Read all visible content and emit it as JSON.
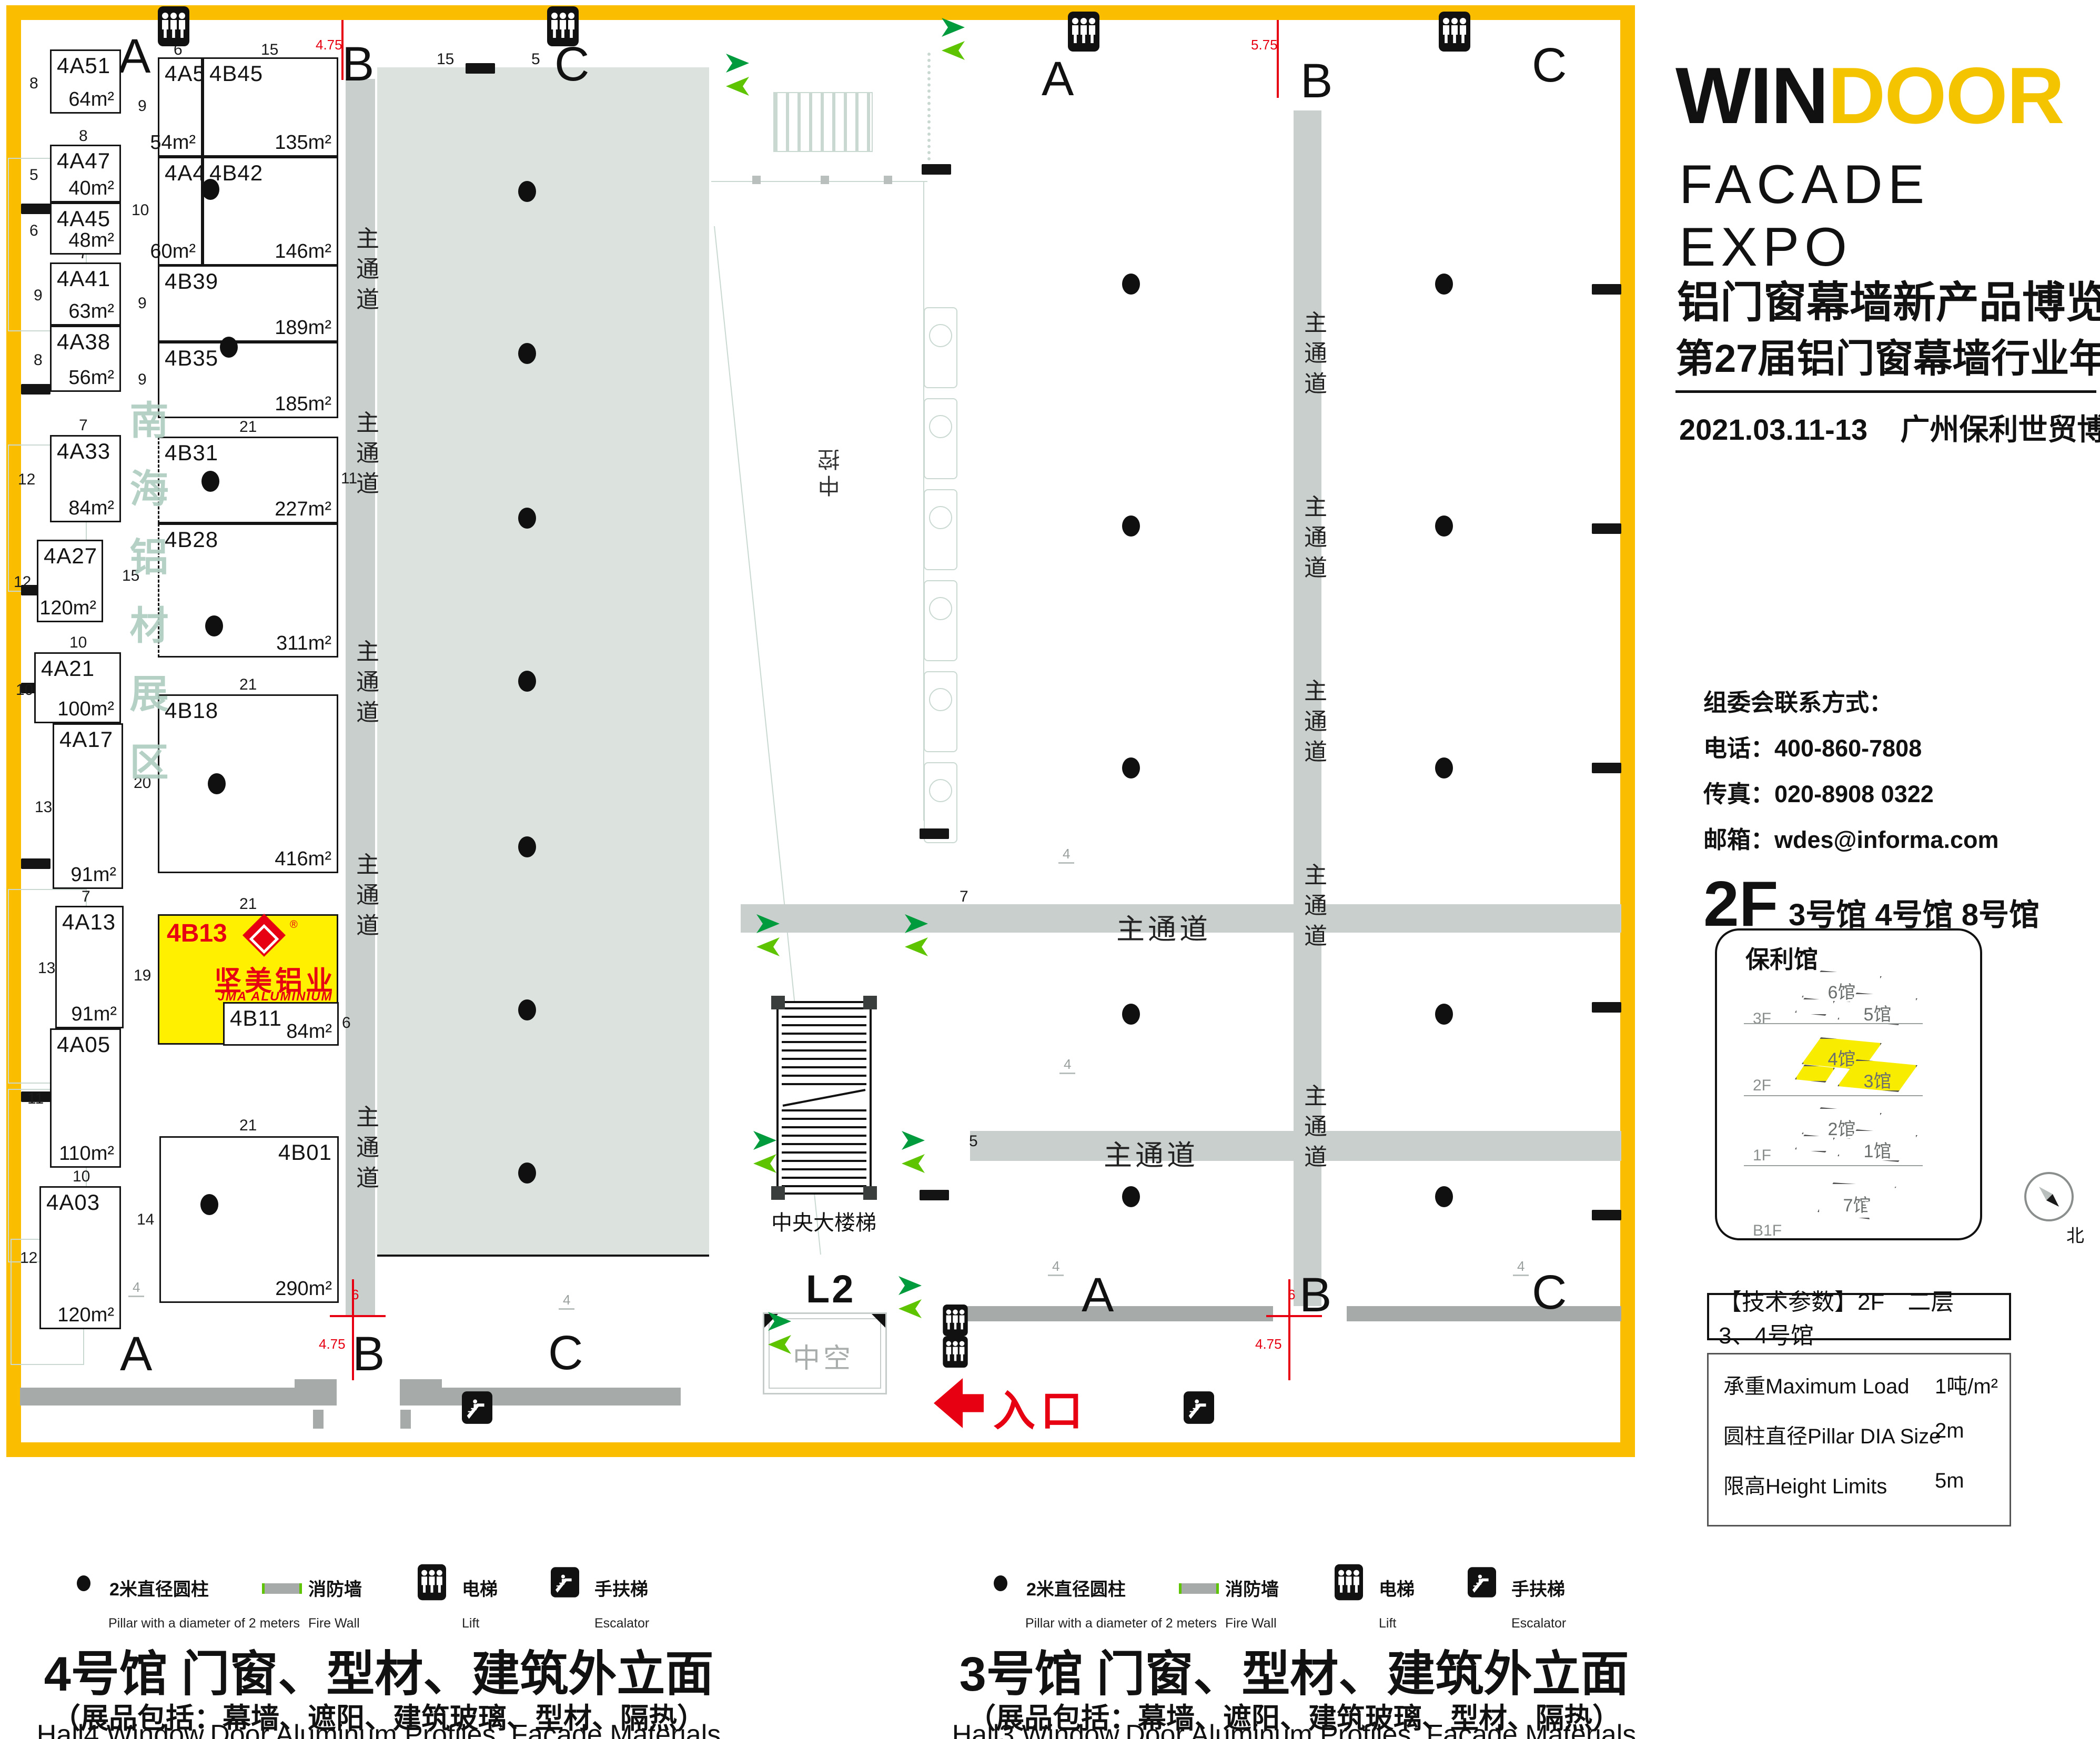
{
  "branding": {
    "title_win": "WIN",
    "title_door": "DOOR",
    "subtitle": "FACADE EXPO",
    "expo_cn": "铝门窗幕墙新产品博览会",
    "annual_cn": "第27届铝门窗幕墙行业年会",
    "date": "2021.03.11-13",
    "venue": "广州保利世贸博览馆"
  },
  "contact": {
    "heading": "组委会联系方式：",
    "phone": "电话：400-860-7808",
    "fax": "传真：020-8908 0322",
    "email": "邮箱：wdes@informa.com"
  },
  "sidebar": {
    "floor": "2F",
    "floor_halls": "3号馆 4号馆 8号馆",
    "building": "保利馆",
    "levels": [
      {
        "label": "3F",
        "halls": [
          "6馆",
          "5馆"
        ],
        "accent": false
      },
      {
        "label": "2F",
        "halls": [
          "4馆",
          "3馆"
        ],
        "accent": true
      },
      {
        "label": "1F",
        "halls": [
          "2馆",
          "1馆"
        ],
        "accent": false
      },
      {
        "label": "B1F",
        "halls": [
          "7馆"
        ],
        "accent": false
      }
    ],
    "compass_north": "北"
  },
  "tech_params": {
    "title": "【技术参数】2F　二层　　3、4号馆",
    "rows": [
      {
        "label": "承重Maximum Load",
        "value": "1吨/m²"
      },
      {
        "label": "圆柱直径Pillar DIA Size",
        "value": "2m"
      },
      {
        "label": "限高Height Limits",
        "value": "5m"
      }
    ]
  },
  "legend": {
    "pillar_cn": "2米直径圆柱",
    "pillar_en": "Pillar with a diameter of 2 meters",
    "firewall_cn": "消防墙",
    "firewall_en": "Fire Wall",
    "lift_cn": "电梯",
    "lift_en": "Lift",
    "escalator_cn": "手扶梯",
    "escalator_en": "Escalator"
  },
  "captions": {
    "hall4": {
      "title": "4号馆 门窗、型材、建筑外立面",
      "subtitle": "（展品包括：幕墙、遮阳、建筑玻璃、型材、隔热）",
      "en": "Hall4 Window,Door,Aluminum Profiles, Facade Materials"
    },
    "hall3": {
      "title": "3号馆 门窗、型材、建筑外立面",
      "subtitle": "（展品包括：幕墙、遮阳、建筑玻璃、型材、隔热）",
      "en": "Hall3 Window,Door,Aluminum Profiles, Facade Materials"
    }
  },
  "plan": {
    "watermark": "南海铝材展区",
    "aisle_label": "主通道",
    "stair_label": "中央大楼梯",
    "void_label": "中空",
    "control_label": "中控",
    "l2_label": "L2",
    "entrance_label": "入口",
    "frame": [
      12,
      10,
      3096,
      2760
    ],
    "gray_area": [
      717,
      128,
      631,
      2257
    ],
    "letters": [
      [
        "A",
        225,
        55
      ],
      [
        "B",
        650,
        70
      ],
      [
        "C",
        1054,
        70
      ],
      [
        "A",
        1980,
        98
      ],
      [
        "B",
        2472,
        102
      ],
      [
        "C",
        2912,
        72
      ],
      [
        "A",
        228,
        2522
      ],
      [
        "B",
        670,
        2522
      ],
      [
        "C",
        1042,
        2520
      ],
      [
        "A",
        2056,
        2410
      ],
      [
        "B",
        2470,
        2410
      ],
      [
        "C",
        2912,
        2405
      ]
    ],
    "booths": [
      {
        "c": "4A51",
        "a": "64m²",
        "r": [
          95,
          94,
          135,
          122
        ]
      },
      {
        "c": "4A47",
        "a": "40m²",
        "r": [
          95,
          275,
          135,
          110
        ]
      },
      {
        "c": "4A45",
        "a": "48m²",
        "r": [
          95,
          385,
          135,
          99
        ]
      },
      {
        "c": "4A41",
        "a": "63m²",
        "r": [
          95,
          499,
          135,
          120
        ]
      },
      {
        "c": "4A38",
        "a": "56m²",
        "r": [
          95,
          619,
          135,
          126
        ]
      },
      {
        "c": "4A33",
        "a": "84m²",
        "r": [
          95,
          827,
          135,
          166
        ]
      },
      {
        "c": "4A27",
        "a": "120m²",
        "r": [
          70,
          1026,
          126,
          157
        ]
      },
      {
        "c": "4A21",
        "a": "100m²",
        "r": [
          65,
          1240,
          165,
          135
        ]
      },
      {
        "c": "4A17",
        "a": "91m²",
        "r": [
          100,
          1375,
          134,
          315
        ]
      },
      {
        "c": "4A13",
        "a": "91m²",
        "r": [
          105,
          1722,
          130,
          233
        ]
      },
      {
        "c": "4A05",
        "a": "110m²",
        "r": [
          95,
          1955,
          135,
          265
        ]
      },
      {
        "c": "4A03",
        "a": "120m²",
        "r": [
          75,
          2255,
          155,
          272
        ]
      },
      {
        "c": "4A52",
        "a": "54m²",
        "r": [
          300,
          109,
          85,
          189
        ]
      },
      {
        "c": "4B45",
        "a": "135m²",
        "r": [
          385,
          109,
          258,
          189
        ]
      },
      {
        "c": "4A46",
        "a": "60m²",
        "r": [
          300,
          298,
          85,
          207
        ]
      },
      {
        "c": "4B42",
        "a": "146m²",
        "r": [
          385,
          298,
          258,
          207
        ]
      },
      {
        "c": "4B39",
        "a": "189m²",
        "r": [
          300,
          504,
          343,
          146
        ]
      },
      {
        "c": "4B35",
        "a": "185m²",
        "r": [
          300,
          650,
          343,
          145
        ]
      },
      {
        "c": "4B31",
        "a": "227m²",
        "r": [
          300,
          830,
          343,
          165
        ],
        "dashed": true
      },
      {
        "c": "4B28",
        "a": "311m²",
        "r": [
          300,
          995,
          343,
          255
        ],
        "dashed": true
      },
      {
        "c": "4B18",
        "a": "416m²",
        "r": [
          300,
          1320,
          343,
          340
        ]
      },
      {
        "c": "4B13",
        "a": "",
        "r": [
          300,
          1738,
          343,
          248
        ],
        "yellow": true,
        "featured": true
      },
      {
        "c": "4B11",
        "a": "84m²",
        "r": [
          424,
          1905,
          220,
          83
        ]
      },
      {
        "c": "4B01",
        "a": "290m²",
        "r": [
          303,
          2160,
          341,
          317
        ],
        "codeRight": true
      }
    ],
    "featured": {
      "code": "4B13",
      "company_cn": "坚美铝业",
      "company_en": "JMA ALUMINIUM",
      "reg": "®"
    },
    "dims": [
      [
        "8",
        56,
        142
      ],
      [
        "5",
        56,
        316
      ],
      [
        "6",
        56,
        422
      ],
      [
        "9",
        64,
        545
      ],
      [
        "8",
        64,
        668
      ],
      [
        "12",
        34,
        895
      ],
      [
        "12",
        26,
        1090
      ],
      [
        "10",
        30,
        1295
      ],
      [
        "13",
        66,
        1518
      ],
      [
        "13",
        72,
        1824
      ],
      [
        "11",
        52,
        2072
      ],
      [
        "12",
        38,
        2375
      ],
      [
        "8",
        150,
        242
      ],
      [
        "7",
        150,
        465
      ],
      [
        "7",
        150,
        792
      ],
      [
        "10",
        132,
        1205
      ],
      [
        "7",
        155,
        1688
      ],
      [
        "10",
        138,
        2220
      ],
      [
        "6",
        330,
        78
      ],
      [
        "15",
        496,
        78
      ],
      [
        "21",
        455,
        468
      ],
      [
        "21",
        455,
        795
      ],
      [
        "21",
        455,
        1285
      ],
      [
        "21",
        455,
        1702
      ],
      [
        "21",
        455,
        2123
      ],
      [
        "9",
        262,
        185
      ],
      [
        "10",
        250,
        383
      ],
      [
        "9",
        262,
        560
      ],
      [
        "9",
        262,
        705
      ],
      [
        "15",
        232,
        1078
      ],
      [
        "20",
        254,
        1472
      ],
      [
        "19",
        254,
        1838
      ],
      [
        "14",
        260,
        2302
      ],
      [
        "11",
        648,
        893
      ],
      [
        "6",
        650,
        1928
      ],
      [
        "15",
        830,
        96
      ],
      [
        "5",
        1010,
        96
      ],
      [
        "7",
        1824,
        1688
      ],
      [
        "5",
        1842,
        2153
      ]
    ],
    "dims_gray": [
      [
        "4",
        244,
        2432
      ],
      [
        "4",
        1062,
        2456
      ],
      [
        "4",
        2012,
        1608
      ],
      [
        "4",
        2014,
        2008
      ],
      [
        "4",
        1992,
        2392
      ],
      [
        "4",
        2876,
        2392
      ]
    ],
    "dims_red": [
      [
        "4.75",
        600,
        70
      ],
      [
        "5.75",
        2378,
        70
      ],
      [
        "6",
        668,
        2446
      ],
      [
        "4.75",
        606,
        2540
      ],
      [
        "6",
        2448,
        2446
      ],
      [
        "4.75",
        2386,
        2540
      ]
    ],
    "red_lines": [
      [
        649,
        38,
        4,
        114
      ],
      [
        2427,
        38,
        4,
        148
      ],
      [
        669,
        2432,
        4,
        192
      ],
      [
        2449,
        2432,
        4,
        192
      ],
      [
        627,
        2500,
        106,
        4
      ],
      [
        2407,
        2500,
        106,
        4
      ]
    ],
    "aisles": [
      [
        657,
        150,
        56,
        2350
      ],
      [
        2459,
        210,
        53,
        2273
      ],
      [
        1408,
        1719,
        1674,
        54
      ],
      [
        1844,
        2150,
        1238,
        57
      ]
    ],
    "aisle_labels_v": [
      [
        662,
        430
      ],
      [
        662,
        780
      ],
      [
        662,
        1215
      ],
      [
        662,
        1620
      ],
      [
        662,
        2100
      ],
      [
        2464,
        590
      ],
      [
        2464,
        940
      ],
      [
        2464,
        1290
      ],
      [
        2464,
        1640
      ],
      [
        2464,
        2060
      ]
    ],
    "aisle_labels_h": [
      [
        2122,
        1722
      ],
      [
        2098,
        2152
      ]
    ],
    "walls": [
      [
        38,
        2638,
        602,
        34
      ],
      [
        760,
        2638,
        534,
        34
      ],
      [
        560,
        2622,
        80,
        34
      ],
      [
        760,
        2622,
        80,
        34
      ],
      [
        1838,
        2483,
        582,
        29
      ],
      [
        2560,
        2483,
        522,
        29
      ],
      [
        595,
        2680,
        20,
        36
      ],
      [
        761,
        2680,
        20,
        36
      ]
    ],
    "firewalls": [
      [
        40,
        387
      ],
      [
        40,
        730
      ],
      [
        40,
        1112
      ],
      [
        40,
        1298
      ],
      [
        40,
        1632
      ],
      [
        40,
        2075
      ],
      [
        3026,
        540
      ],
      [
        3026,
        995
      ],
      [
        3026,
        1450
      ],
      [
        3026,
        1905
      ],
      [
        3026,
        2300
      ],
      [
        885,
        120
      ],
      [
        1752,
        312
      ],
      [
        1748,
        1575
      ],
      [
        1748,
        2262
      ]
    ],
    "pillars": [
      [
        1002,
        364
      ],
      [
        1002,
        672
      ],
      [
        1002,
        985
      ],
      [
        1002,
        1295
      ],
      [
        1002,
        1610
      ],
      [
        1002,
        1920
      ],
      [
        1002,
        2230
      ],
      [
        2150,
        540
      ],
      [
        2150,
        1000
      ],
      [
        2150,
        1460
      ],
      [
        2150,
        1928
      ],
      [
        2150,
        2275
      ],
      [
        2745,
        540
      ],
      [
        2745,
        1000
      ],
      [
        2745,
        1460
      ],
      [
        2745,
        1928
      ],
      [
        2745,
        2275
      ],
      [
        400,
        360
      ],
      [
        435,
        660
      ],
      [
        400,
        915
      ],
      [
        407,
        1190
      ],
      [
        412,
        1490
      ],
      [
        398,
        2290
      ]
    ],
    "arrows": [
      [
        1372,
        100
      ],
      [
        1782,
        32
      ],
      [
        1430,
        1736
      ],
      [
        1712,
        1736
      ],
      [
        1424,
        2148
      ],
      [
        1706,
        2148
      ],
      [
        1452,
        2492
      ],
      [
        1700,
        2424
      ]
    ],
    "lift_icons": [
      [
        300,
        12
      ],
      [
        1040,
        12
      ],
      [
        2030,
        22
      ],
      [
        2735,
        22
      ]
    ],
    "lift_double": [
      1792,
      2480
    ],
    "escalators": [
      [
        878,
        2645
      ],
      [
        2250,
        2645
      ]
    ],
    "stair": {
      "r": [
        1476,
        1903,
        181,
        368
      ],
      "label_y": 2292
    },
    "voidbox": {
      "r": [
        1450,
        2495,
        230,
        150
      ]
    },
    "l2_pos": [
      1532,
      2408
    ],
    "control_pos": [
      1548,
      845
    ],
    "entrance": {
      "arrow": [
        1775,
        2620,
        95,
        95
      ],
      "label": [
        1888,
        2618
      ]
    }
  }
}
